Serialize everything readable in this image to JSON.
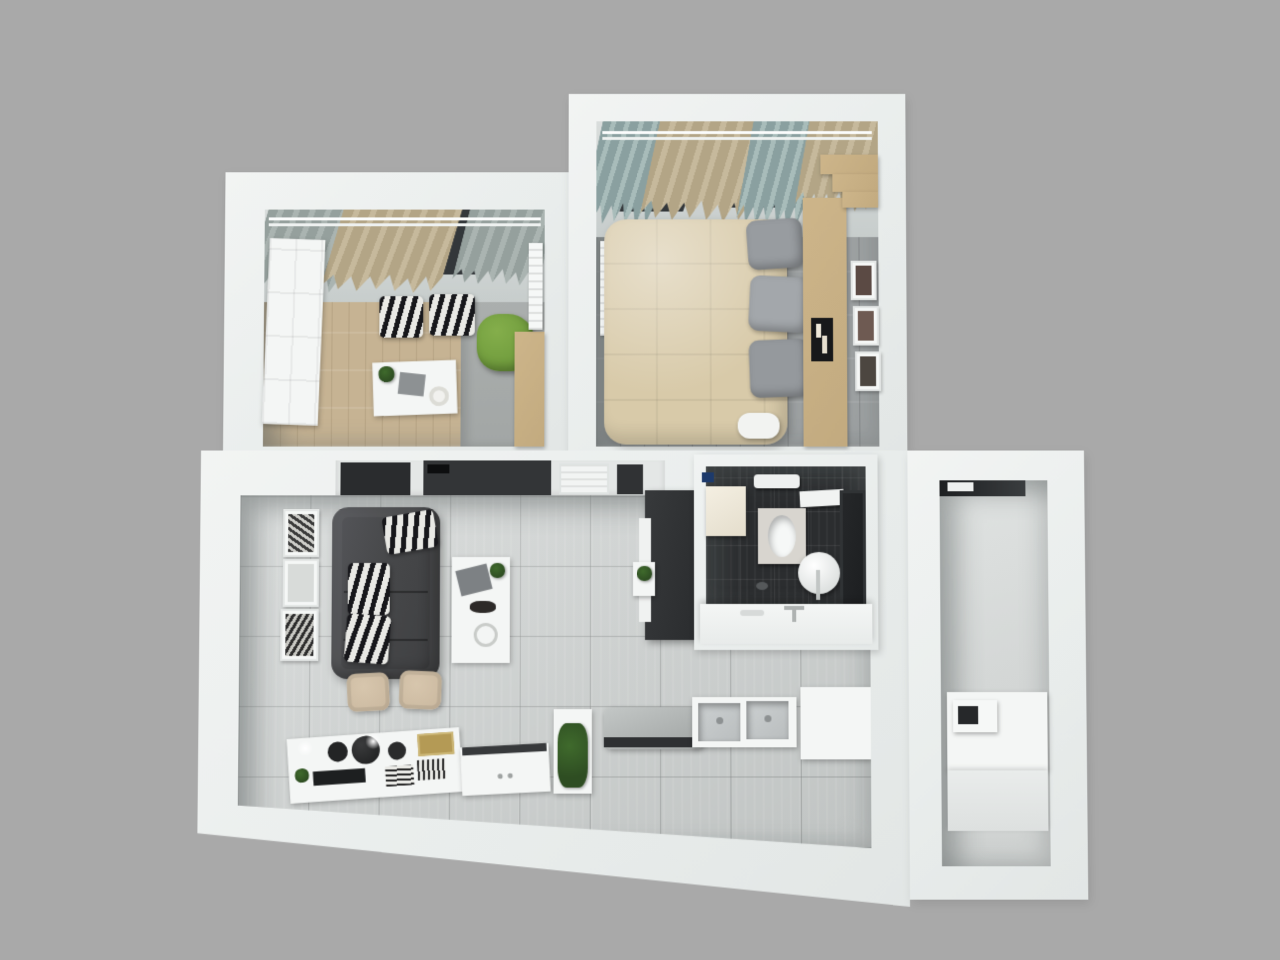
{
  "view": {
    "type": "3d-floor-plan-top-down-render",
    "scene": "one-bedroom-apartment-interior"
  },
  "rooms": [
    {
      "name": "study-bedroom",
      "position": "top-left",
      "floor": "light-wood-and-gray",
      "furniture": [
        "window-curtains",
        "white-panel-door",
        "zebra-ottoman",
        "zebra-ottoman",
        "green-armchair",
        "white-desk",
        "desk-plant",
        "wood-wardrobe",
        "wall-radiator"
      ]
    },
    {
      "name": "master-bedroom",
      "position": "top-right",
      "floor": "gray-wood",
      "furniture": [
        "window-curtains",
        "double-bed-beige-duvet",
        "gray-pillows",
        "white-pillow",
        "wood-headboard-console",
        "candle-tray",
        "picture-frames",
        "stepped-wardrobe",
        "wall-radiator"
      ]
    },
    {
      "name": "living-kitchen",
      "position": "bottom-center",
      "floor": "light-gray-tile",
      "furniture": [
        "tv-panel-wall",
        "air-vent",
        "dark-gray-sofa",
        "zebra-cushions",
        "coffee-table",
        "table-plant",
        "picture-frames",
        "media-cabinet",
        "shelf-plant",
        "dining-chairs",
        "decor-console",
        "black-bowls",
        "gold-board",
        "serving-tray",
        "counter-plant",
        "cooktop",
        "double-sink",
        "kitchen-peninsula"
      ]
    },
    {
      "name": "bathroom",
      "position": "center-right",
      "floor": "dark-tile",
      "furniture": [
        "washing-machine",
        "towel-rail",
        "wall-shelf",
        "toilet",
        "pedestal-sink",
        "vanity-counter",
        "dark-door"
      ]
    },
    {
      "name": "balcony-room",
      "position": "right",
      "floor": "light-gray",
      "furniture": [
        "window-frame",
        "counter",
        "microwave",
        "low-step"
      ]
    }
  ],
  "colors": {
    "background": "#a9a9a9",
    "wall": "#e9edec",
    "wall_bright": "#f2f4f3",
    "tile_floor": "#ccd0cf",
    "wood_floor": "#c6b393",
    "gray_wood_floor": "#9da1a2",
    "dark_tile": "#2b2d2f",
    "sofa": "#47484a",
    "duvet": "#d8caa9",
    "pillow_gray": "#989ca0",
    "wood_furniture": "#c2aa7f",
    "green_chair": "#6f9b3c",
    "plant_green": "#2e4d22",
    "curtain_tan": "#b3a586",
    "curtain_gray": "#95a09d",
    "window_dark": "#33373a",
    "black_panel": "#2a2c2e",
    "steel": "#b9bdbe",
    "chair_beige": "#c9b79e",
    "gold_board": "#b49a55"
  }
}
